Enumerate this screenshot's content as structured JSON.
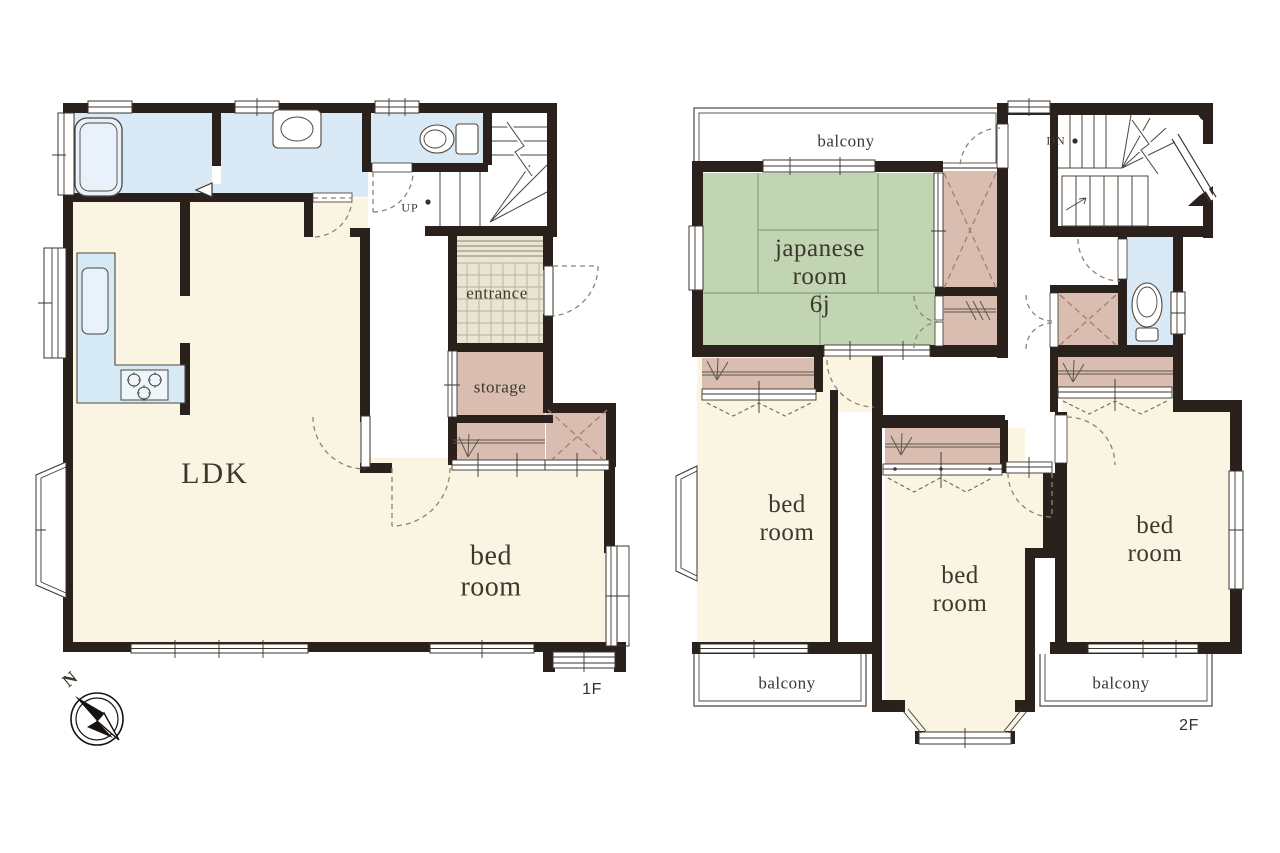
{
  "document": {
    "type": "residential floor plan",
    "floors": 2
  },
  "colors": {
    "wall": "#2b211c",
    "room_cream": "#faf5e2",
    "wet_blue": "#d9e9f6",
    "tatami_green": "#c2d5b3",
    "closet_pink": "#d9bdb0",
    "entrance_tile": "#eae4d2",
    "label_text": "#3c372f",
    "door_dash": "#8d8472"
  },
  "floor1": {
    "floor_label": "1F",
    "compass_label": "N",
    "rooms": {
      "ldk": "LDK",
      "bedroom": "bed\nroom",
      "entrance": "entrance",
      "storage": "storage"
    },
    "stairs": {
      "direction": "UP"
    }
  },
  "floor2": {
    "floor_label": "2F",
    "rooms": {
      "japanese_room": "japanese\nroom\n6j",
      "bedroom_left": "bed\nroom",
      "bedroom_middle": "bed\nroom",
      "bedroom_right": "bed\nroom",
      "balcony_top": "balcony",
      "balcony_bottom_left": "balcony",
      "balcony_bottom_right": "balcony"
    },
    "stairs": {
      "direction": "DN"
    }
  }
}
